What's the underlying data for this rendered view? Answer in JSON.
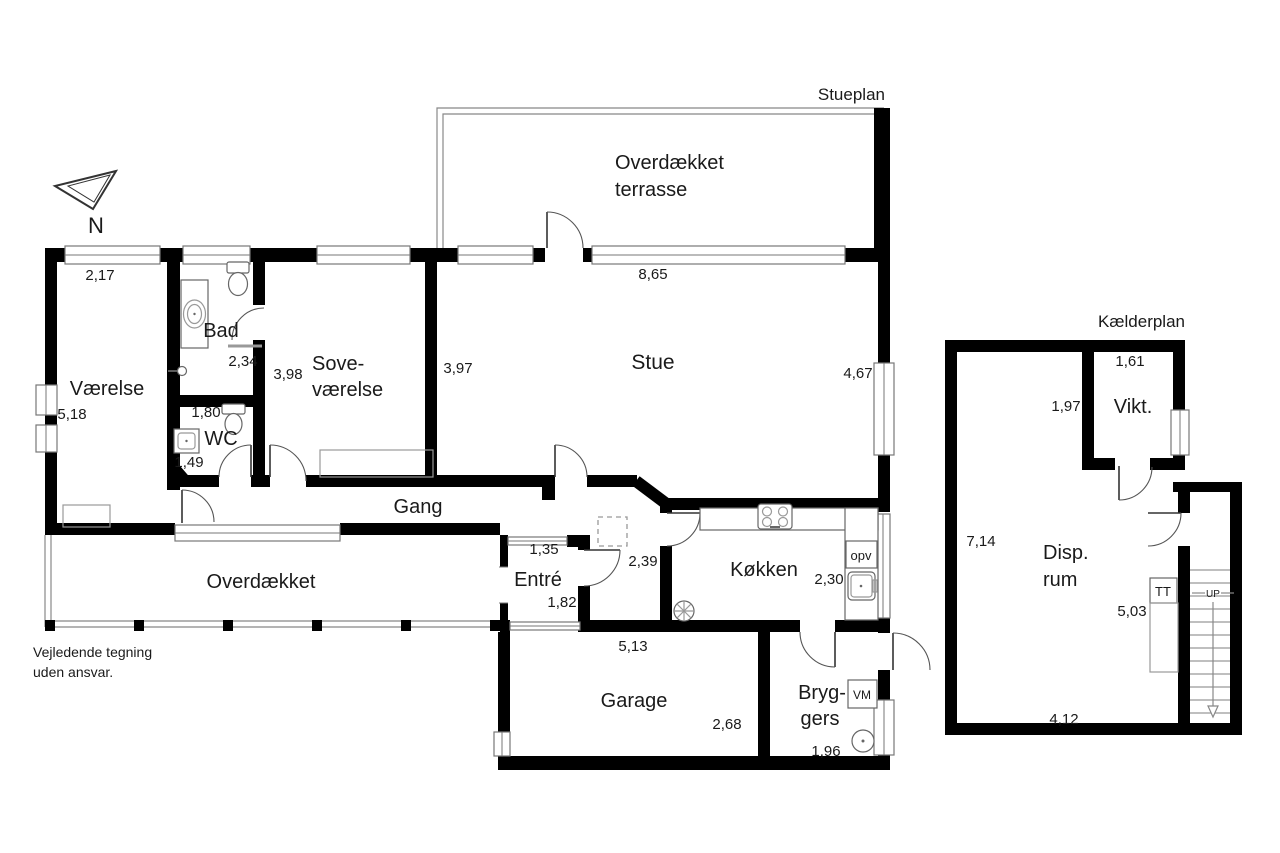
{
  "plans": {
    "ground_title": "Stueplan",
    "basement_title": "Kælderplan"
  },
  "rooms": {
    "terrace_line1": "Overdækket",
    "terrace_line2": "terrasse",
    "vaerelse": "Værelse",
    "bad": "Bad",
    "wc": "WC",
    "sove_line1": "Sove-",
    "sove_line2": "værelse",
    "stue": "Stue",
    "gang": "Gang",
    "porch": "Overdækket",
    "entre": "Entré",
    "koekken": "Køkken",
    "garage": "Garage",
    "bryggers_line1": "Bryg-",
    "bryggers_line2": "gers",
    "vikt": "Vikt.",
    "disp_line1": "Disp.",
    "disp_line2": "rum"
  },
  "fixtures": {
    "dishwasher": "opv",
    "washing_machine": "VM",
    "dryer": "TT",
    "stairs_up": "UP"
  },
  "dims": {
    "vaerelse_w": "2,17",
    "stue_top": "8,65",
    "bad_h": "2,34",
    "sove_h": "3,98",
    "stue_left": "3,97",
    "stue_right": "4,67",
    "vaerelse_h": "5,18",
    "wc_w": "1,80",
    "wc_h": "1,49",
    "entre_w": "1,35",
    "hall_w": "2,39",
    "entre_h": "1,82",
    "koekken_w": "2,30",
    "garage_w": "5,13",
    "garage_h": "2,68",
    "bryggers_w": "1,96",
    "vikt_w": "1,61",
    "vikt_h": "1,97",
    "disp_h": "7,14",
    "stair_h": "5,03",
    "disp_w": "4,12"
  },
  "compass": {
    "north": "N"
  },
  "disclaimer": {
    "line1": "Vejledende tegning",
    "line2": "uden ansvar."
  },
  "colors": {
    "wall": "#000000",
    "detail": "#777777",
    "text": "#1a1a1a",
    "background": "#ffffff"
  }
}
